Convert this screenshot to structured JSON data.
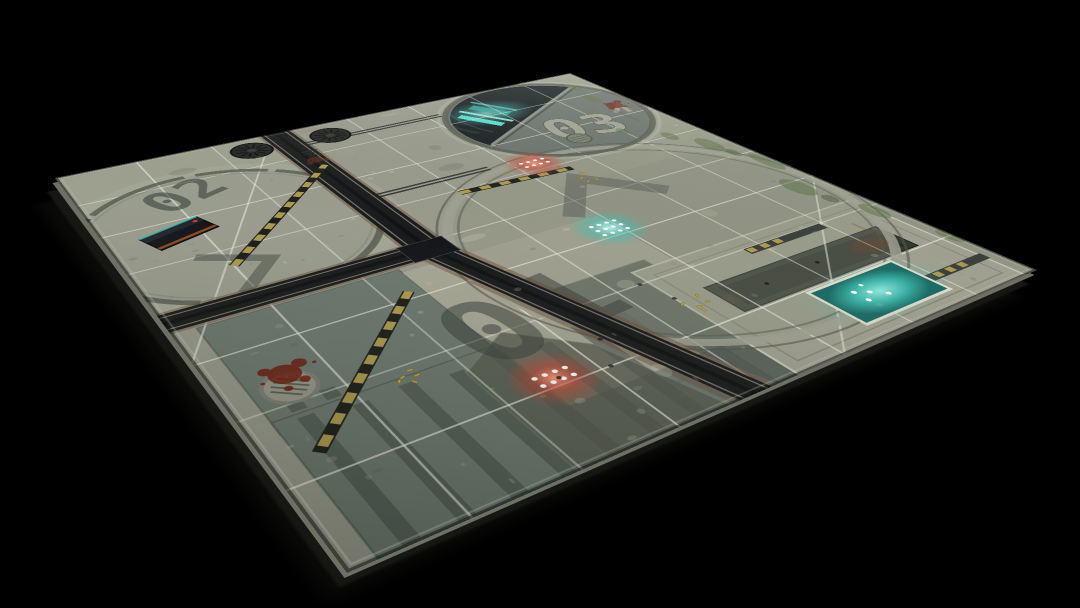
{
  "scene": {
    "title": "Sci-fi battle mat product render",
    "background_color": "#000000"
  },
  "mat": {
    "zone_labels": [
      {
        "id": "zone-01",
        "label": "01"
      },
      {
        "id": "zone-02",
        "label": "02"
      },
      {
        "id": "zone-03",
        "label": "03"
      }
    ],
    "grid": {
      "rows": 8,
      "cols": 8
    },
    "colors": {
      "background": "#000000",
      "base": "#989a8b",
      "plate_green": "#6c796f",
      "concrete_light": "#a8a997",
      "grid_line": "#eeeee4",
      "channel_dark": "#191b1c",
      "hazard_yellow": "#ac9a4e",
      "hazard_black": "#1d1e18",
      "teal": "#3fc2b4",
      "red": "#d0442e",
      "moss": "#5c7046",
      "blood": "#6e1c0e",
      "gold": "#c7a23f",
      "ink": "#3a403a",
      "light_num": "#a3a496"
    }
  }
}
